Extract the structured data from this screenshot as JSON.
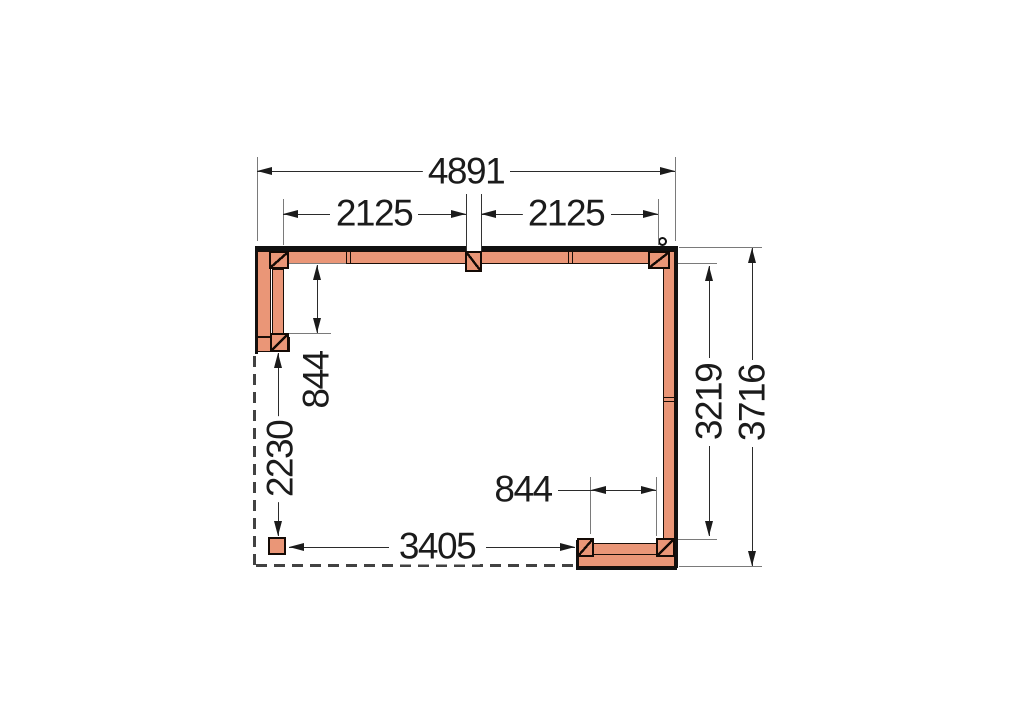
{
  "drawing": {
    "kind": "veranda-floor-plan",
    "dimensions_mm": {
      "overall_width": "4891",
      "bay_left": "2125",
      "bay_right": "2125",
      "left_wall_return": "844",
      "left_open_span": "2230",
      "bottom_open_span": "3405",
      "bottom_right_return": "844",
      "right_inner_depth": "3219",
      "overall_depth": "3716"
    },
    "colors": {
      "timber_fill": "#EA9677",
      "timber_outline": "#1A0E08",
      "frame_black": "#111111",
      "dimension_line": "#2B2B2B",
      "extension_line": "#7A7A7A",
      "dashed_outline": "#424242",
      "background": "#FFFFFF"
    }
  }
}
